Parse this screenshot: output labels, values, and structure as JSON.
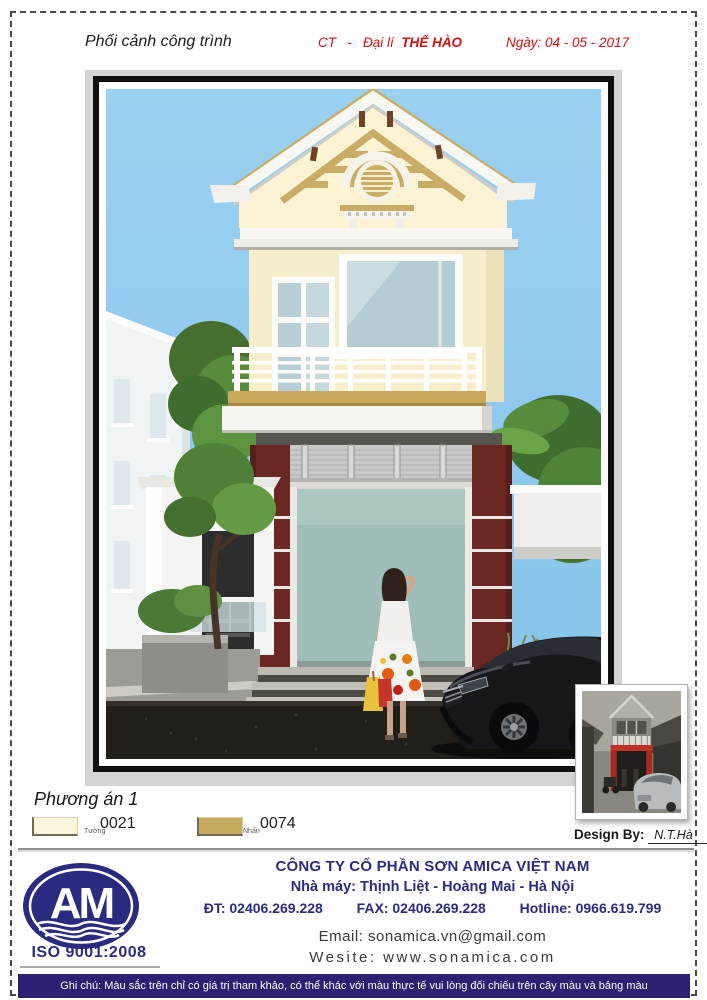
{
  "header": {
    "title": "Phối cảnh công trình",
    "project_code": "CT",
    "separator": "-",
    "dealer_label": "Đại lí",
    "dealer_name": "THẾ HÀO",
    "date": "Ngày: 04 - 05 - 2017"
  },
  "render": {
    "description": "3D perspective render of a two-storey townhouse: cream walls, tan accents, maroon brick ground-floor columns, teal storefront glass, woman with shopping bags, black sedan",
    "palette": {
      "sky": "#8EC9ED",
      "wall_cream": "#FAF3D2",
      "accent_tan": "#C9AD66",
      "brick_maroon": "#6B2823",
      "storefront_glass": "#9FBEBA",
      "road": "#221F1B"
    }
  },
  "inset_photo": {
    "description": "Reference photo of the existing unpainted house"
  },
  "plan": {
    "title": "Phương án 1"
  },
  "swatches": [
    {
      "label": "Tường",
      "code": "0021",
      "color": "#FAF6DC"
    },
    {
      "label": "Nhấn",
      "code": "0074",
      "color": "#C7AB61"
    }
  ],
  "design_by": {
    "label": "Design By:",
    "name": "N.T.Hà"
  },
  "footer": {
    "logo_text": "AM",
    "iso": "ISO 9001:2008",
    "company": "CÔNG TY CỔ PHẦN SƠN AMICA VIỆT NAM",
    "factory": "Nhà máy: Thịnh Liệt - Hoàng Mai - Hà Nội",
    "phone": "ĐT: 02406.269.228",
    "fax": "FAX: 02406.269.228",
    "hotline": "Hotline: 0966.619.799",
    "email": "Email: sonamica.vn@gmail.com",
    "website": "Wesite: www.sonamica.com"
  },
  "note": "Ghi chú: Màu sắc trên chỉ có giá trị tham khảo, có thể khác với màu thực tế vui lòng đối chiếu trên cây màu và bảng màu"
}
